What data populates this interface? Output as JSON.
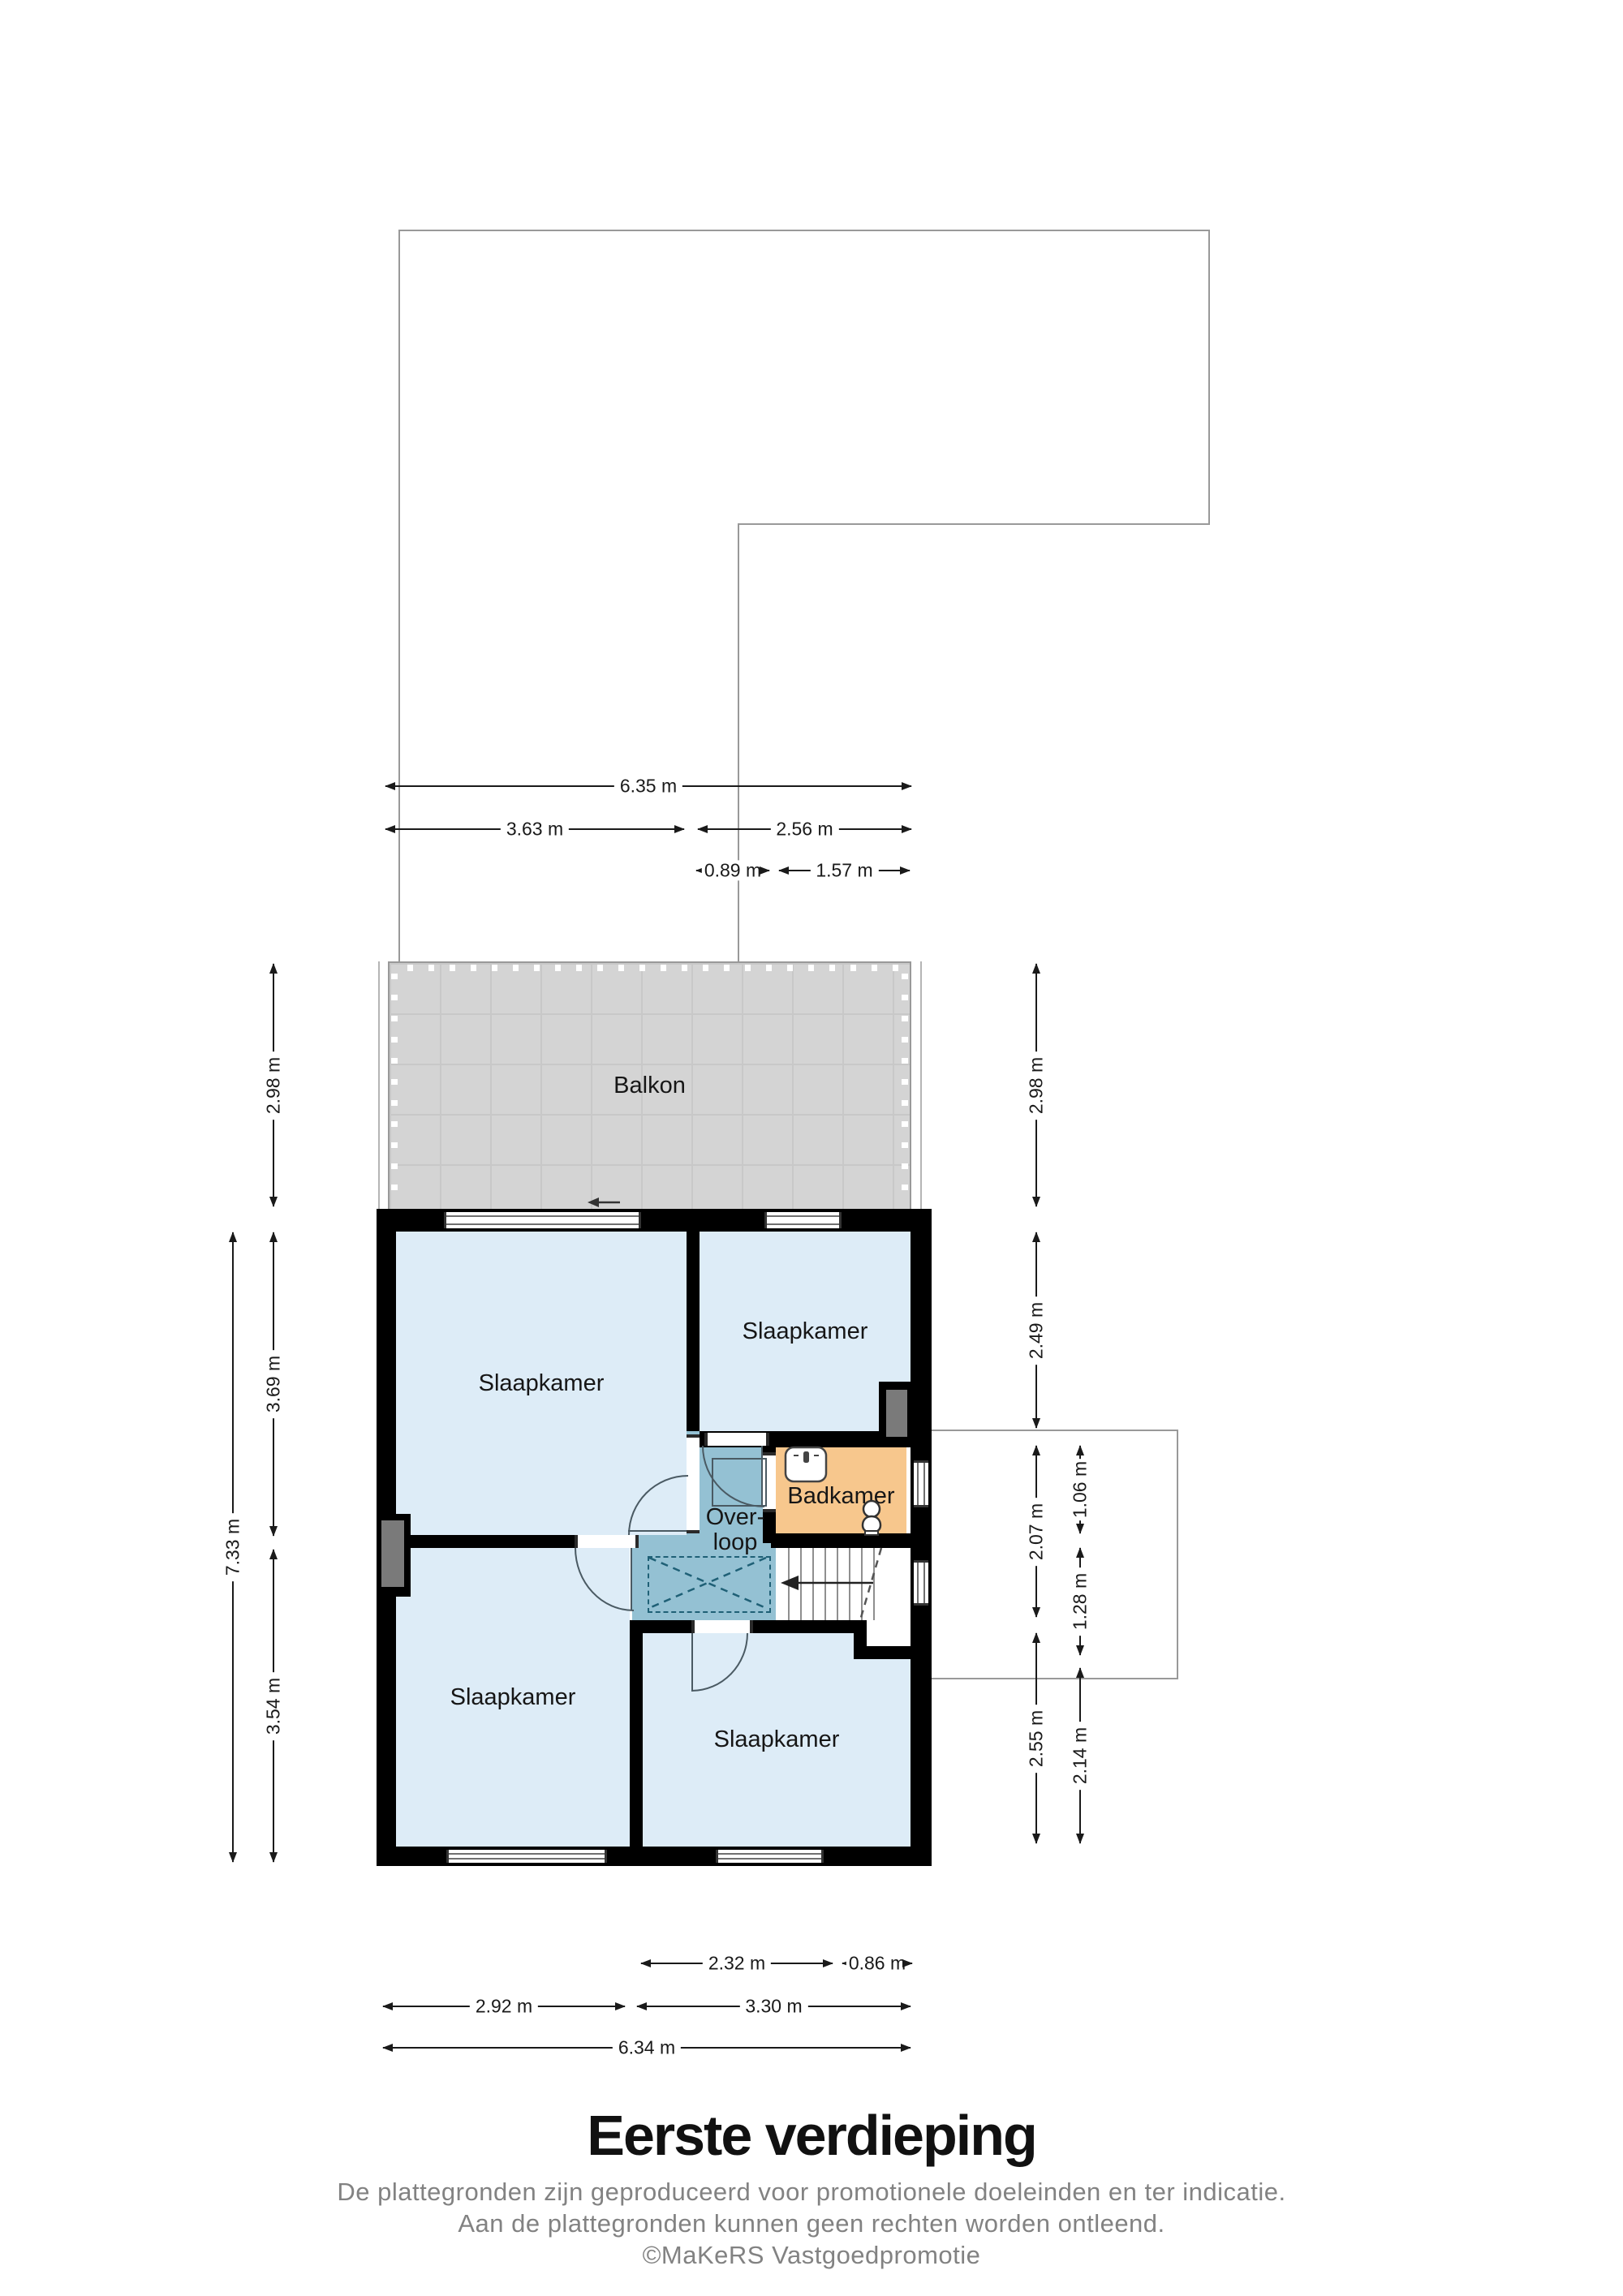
{
  "title": "Eerste verdieping",
  "disclaimer": [
    "De plattegronden zijn geproduceerd voor promotionele doeleinden en ter indicatie.",
    "Aan de plattegronden kunnen geen rechten worden ontleend.",
    "©MaKeRS Vastgoedpromotie"
  ],
  "rooms": {
    "balcony": "Balkon",
    "bedroom": "Slaapkamer",
    "bathroom": "Badkamer",
    "landing_line1": "Over-",
    "landing_line2": "loop"
  },
  "dimensions": {
    "top": [
      "6.35 m",
      "3.63 m",
      "2.56 m",
      "0.89 m",
      "1.57 m"
    ],
    "left": [
      "7.33 m",
      "2.98 m",
      "3.69 m",
      "3.54 m"
    ],
    "right": [
      "2.98 m",
      "2.49 m",
      "2.07 m",
      "2.55 m",
      "1.06 m",
      "1.28 m",
      "2.14 m"
    ],
    "bottom": [
      "2.32 m",
      "0.86 m",
      "2.92 m",
      "3.30 m",
      "6.34 m"
    ]
  },
  "colors": {
    "wall": "#000000",
    "room": "#ddecf7",
    "bath": "#f7c78d",
    "landing": "#94c1d3",
    "balcony": "#d4d4d4",
    "balconyLine": "#c8c8c8",
    "outline": "#999999",
    "duct": "#7a7a7a",
    "dim": "#1a1a1a",
    "door": "#4a5a63",
    "dashline": "#1f6076",
    "glass": "#707070",
    "muted": "#828282"
  }
}
